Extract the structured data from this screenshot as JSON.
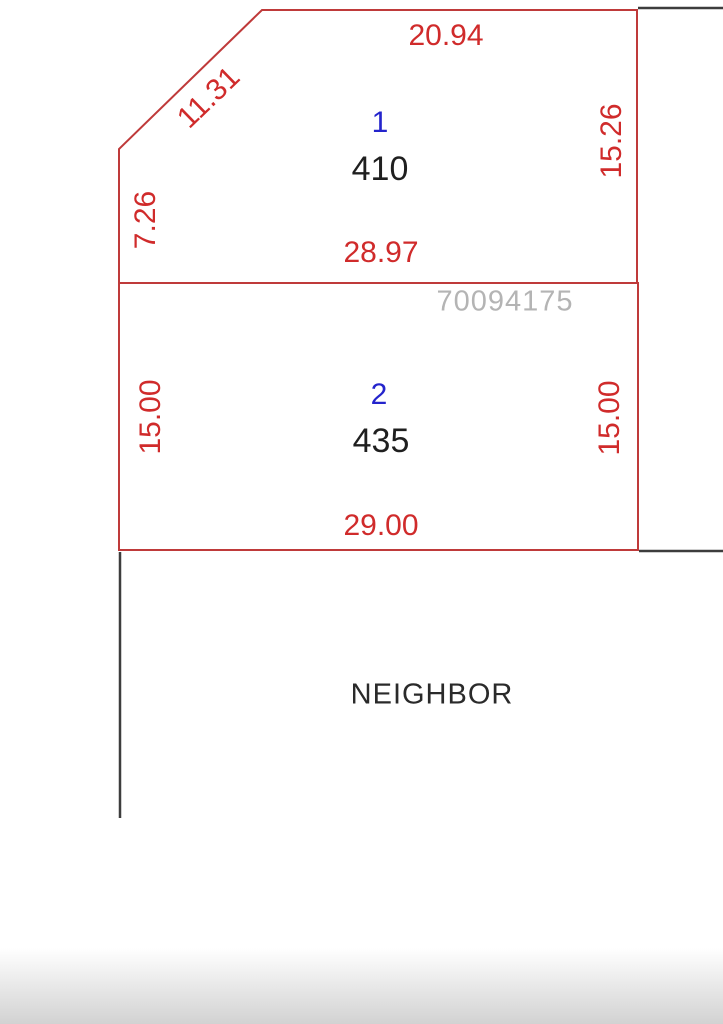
{
  "diagram": {
    "colors": {
      "dimension_text": "#d02b2b",
      "boundary_red": "#bf3a3a",
      "lot_number_blue": "#2424cc",
      "area_black": "#1f1f1f",
      "parcel_id_gray": "#b4b4b4",
      "neighbor_black": "#2a2a2a",
      "boundary_black": "#3d3d3d"
    },
    "lot1": {
      "number": "1",
      "area": "410",
      "dim_top": "20.94",
      "dim_diagonal": "11.31",
      "dim_left": "7.26",
      "dim_right": "15.26",
      "dim_bottom": "28.97"
    },
    "lot2": {
      "number": "2",
      "area": "435",
      "dim_left": "15.00",
      "dim_right": "15.00",
      "dim_bottom": "29.00"
    },
    "parcel_id": "70094175",
    "neighbor_label": "NEIGHBOR"
  }
}
